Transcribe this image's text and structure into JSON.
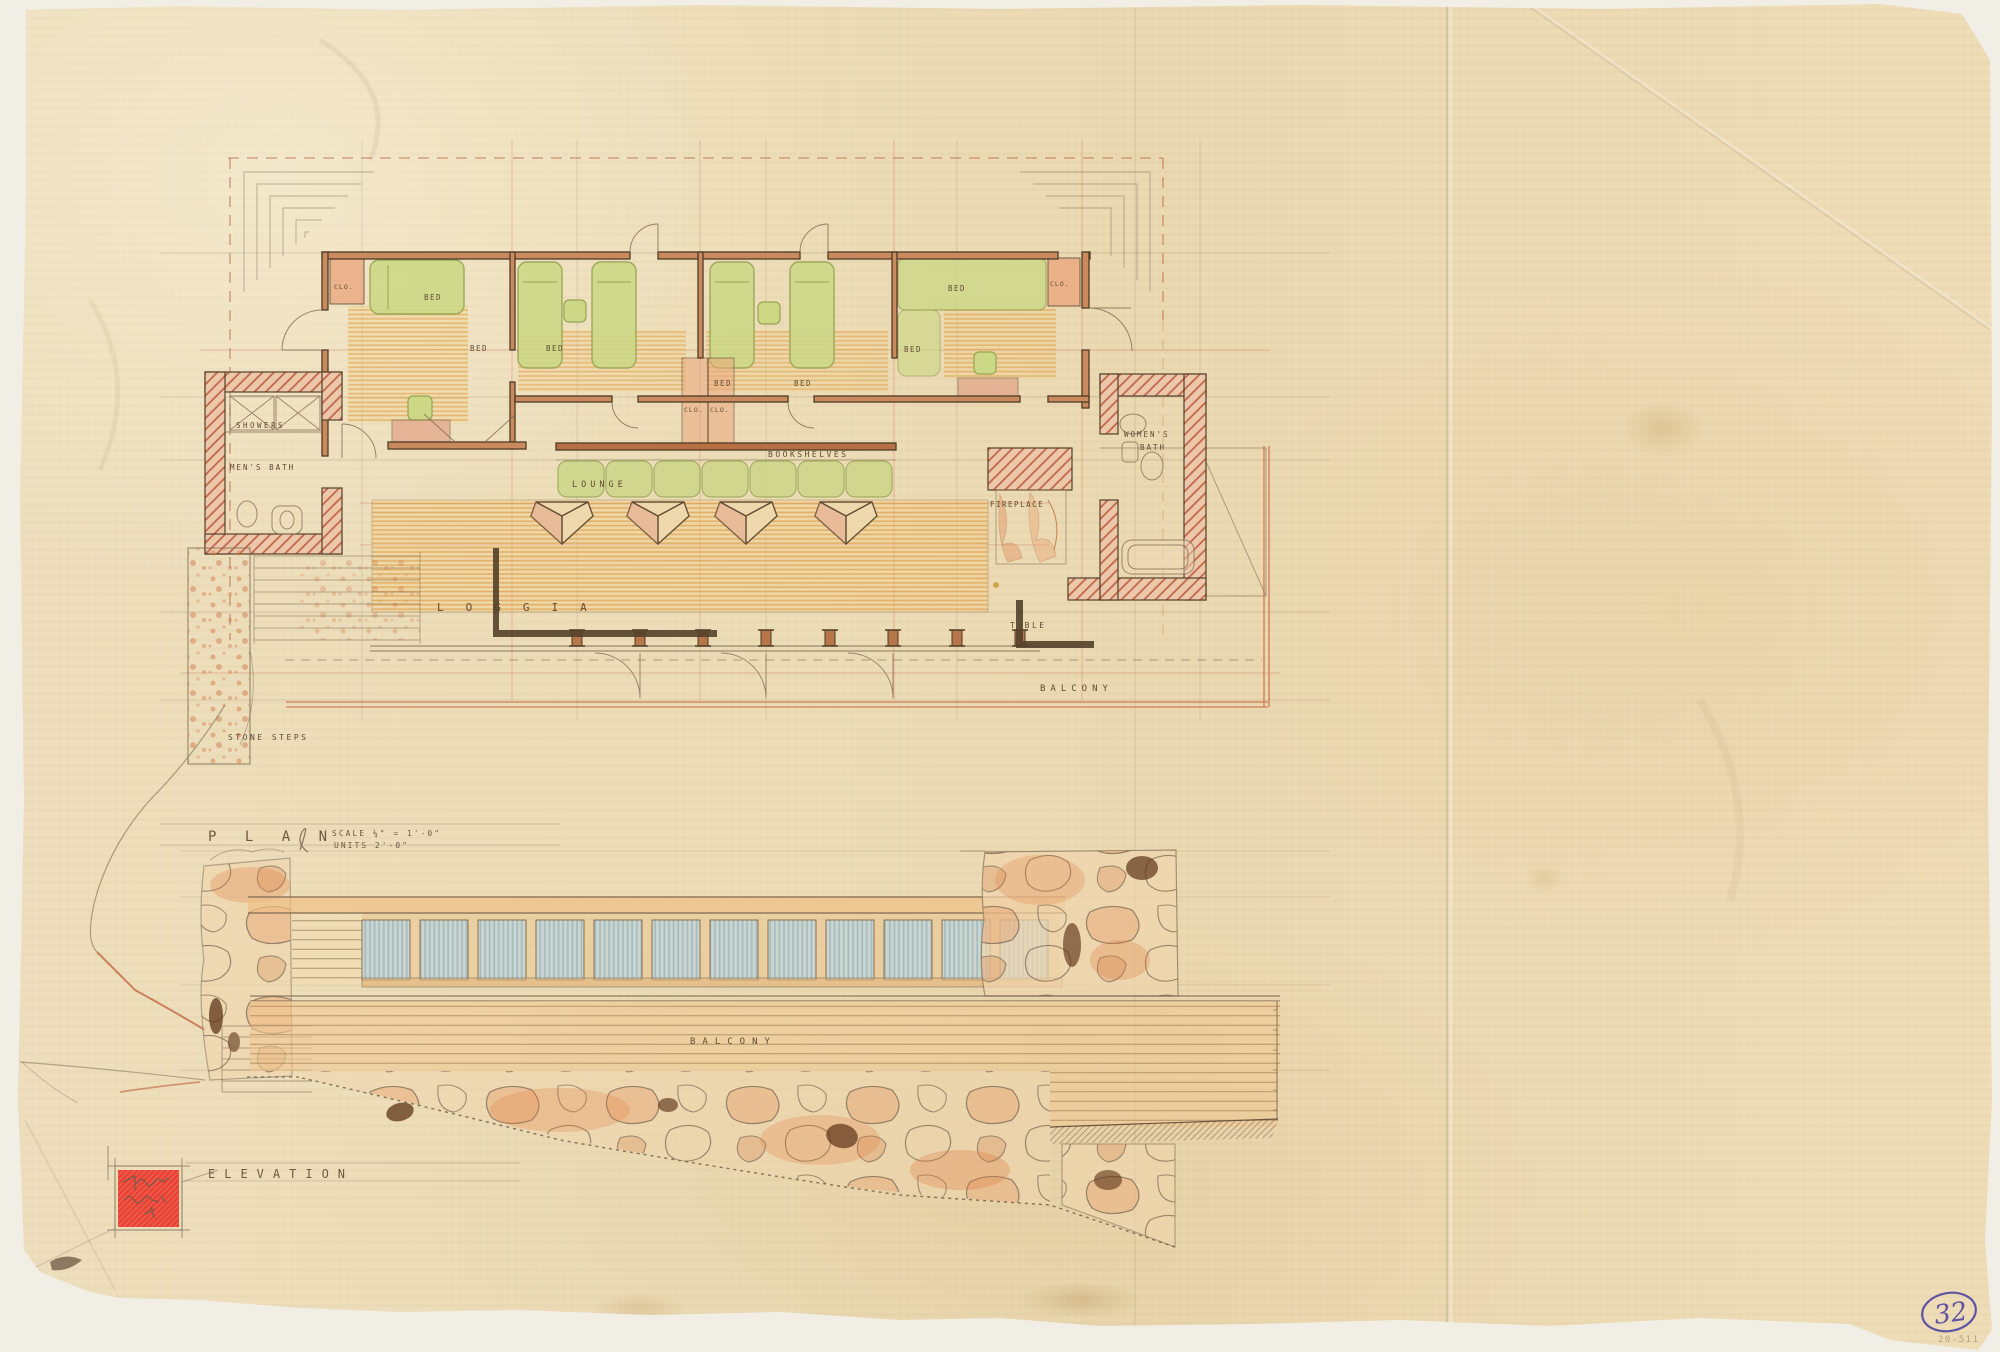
{
  "sheet": {
    "number": "32",
    "catalog_code": "20-511"
  },
  "plan": {
    "title": "P L A N",
    "scale_note": "SCALE ¼\" = 1'-0\"",
    "units_note": "UNITS 2'-0\"",
    "labels": {
      "showers": "SHOWERS",
      "mens_bath": "MEN'S BATH",
      "womens_bath_1": "WOMEN'S",
      "womens_bath_2": "BATH",
      "bed": "BED",
      "closet": "CLO.",
      "bookshelves": "BOOKSHELVES",
      "lounge": "LOUNGE",
      "loggia": "LOGGIA",
      "fireplace": "FIREPLACE",
      "table": "TABLE",
      "balcony": "BALCONY",
      "stone_steps": "STONE STEPS"
    }
  },
  "elevation": {
    "title": "ELEVATION",
    "labels": {
      "balcony": "BALCONY"
    }
  },
  "palette": {
    "paper": "#ecdcb6",
    "sepia_wall": "#54412a",
    "wall_fill": "#c98a5e",
    "masonry_red": "#b65134",
    "floor_orange": "#de9a42",
    "furniture_green": "#cdd887",
    "glass_blue": "#cbd6cf",
    "stamp_red": "#e94233",
    "ink_violet": "#5f54a2"
  }
}
